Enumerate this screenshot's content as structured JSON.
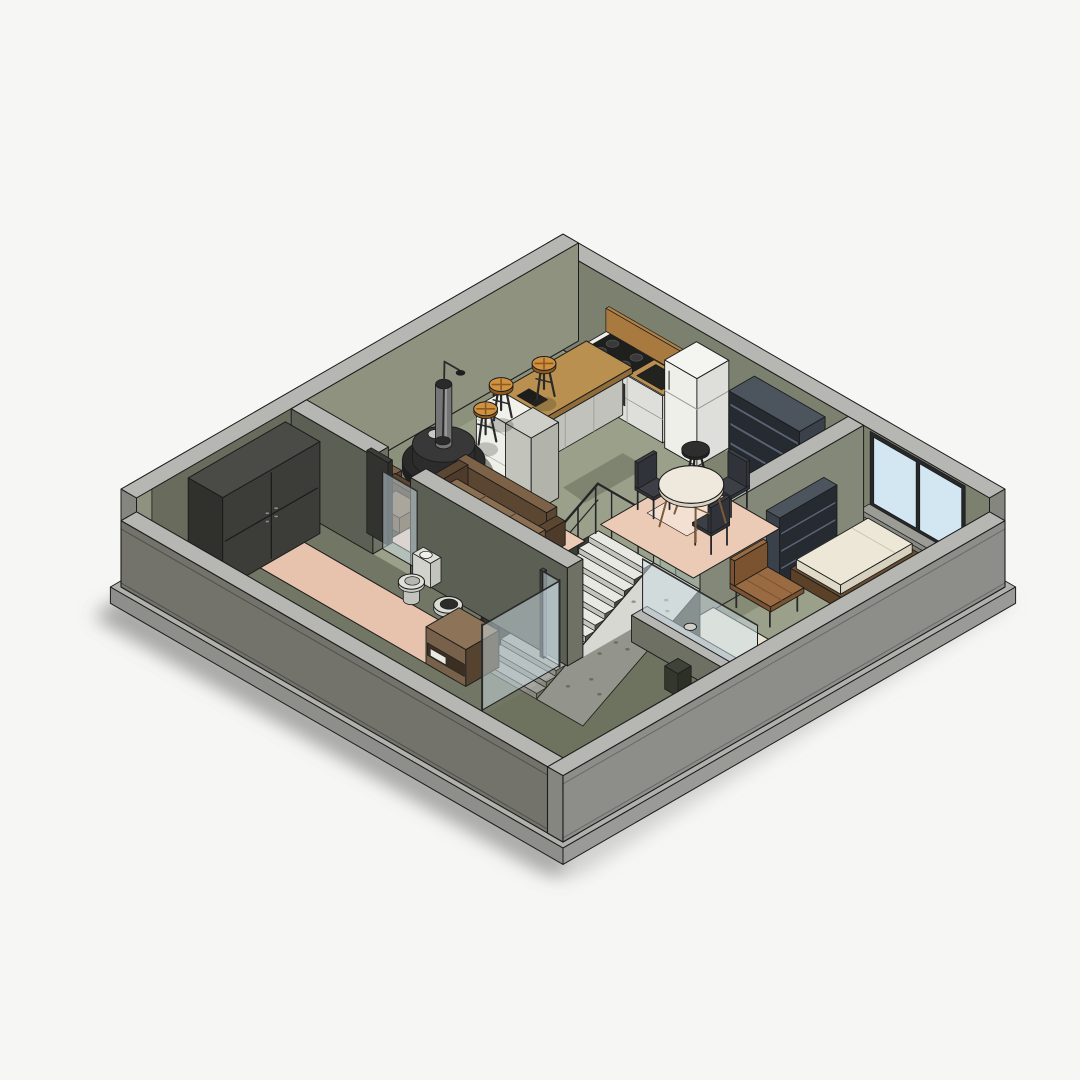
{
  "meta": {
    "title": "Isometric 3D apartment floor plan section render",
    "style": "revit-style cutaway axonometric view",
    "background": "#f6f6f5"
  },
  "rooms": [
    {
      "name": "kitchen"
    },
    {
      "name": "dining-area"
    },
    {
      "name": "living-room"
    },
    {
      "name": "bedroom"
    },
    {
      "name": "bathroom"
    },
    {
      "name": "stairwell"
    },
    {
      "name": "south-room"
    }
  ],
  "objects": [
    "base-slab",
    "drop-shadow",
    "exterior-walls",
    "window-band",
    "kitchen-counter",
    "range-cooktop",
    "kitchen-sink",
    "refrigerator",
    "shelving-unit",
    "kitchen-island",
    "dishwasher",
    "tall-cabinet",
    "bar-stool",
    "black-stool",
    "dining-table",
    "dining-chair",
    "staircase",
    "stair-railing",
    "glass-balustrade",
    "concrete-ramp",
    "bench",
    "bed",
    "area-rug",
    "fireplace",
    "floor-lamp",
    "sofa-large",
    "sofa-small",
    "ottoman",
    "coffee-table",
    "toilet",
    "pedestal-sink",
    "bathroom-vanity",
    "shower-glass",
    "bath-mat",
    "wardrobe",
    "glass-partition",
    "wall-sconce"
  ],
  "palette": {
    "bg": "#f6f6f5",
    "ink": "#1c1c1c",
    "shadow1": "rgba(130,130,127,0.55)",
    "shadow2": "rgba(163,163,160,0.45)",
    "slabTop": "#b0b0ac",
    "slabFace": "#8e8e8a",
    "slabSide": "#9a9a96",
    "wallTop": "#b6b6b2",
    "neFace": "#7c806e",
    "nwFace": "#8e927e",
    "wallDarkFace": "#696c5c",
    "extFaceSW": "#73736c",
    "extFaceSE": "#8d8d89",
    "endCap": "#868680",
    "floor": "#9aa089",
    "floorShadow": "rgba(44,48,36,0.40)",
    "patchShadow": "rgba(50,55,42,0.26)",
    "slotFloor": "#53564a",
    "pitFace": "#43463b",
    "pitFaceW": "#3a3d33",
    "tread": "#e9e9e4",
    "riser": "#c4c4be",
    "ramp": "#d8d8d2",
    "speckle": "#95958b",
    "railing": "#26262a",
    "glassBlue": "#d2e7f1",
    "glassPale": "rgba(203,222,229,0.5)",
    "glassGreen": "rgba(188,210,196,0.45)",
    "frame": "#26282a",
    "woodTop": "#b9904f",
    "woodSide": "#8f6c3a",
    "white": "#efefea",
    "whiteShade": "#dededa",
    "whiteSide": "#cfcfc9",
    "steel": "#2c2c2c",
    "shelfFront": "#262b31",
    "shelfSide": "#3a414a",
    "shelfTop": "#4c545e",
    "shelfSlat": "#566070",
    "orange": "#d09140",
    "orangeDark": "#8a5a20",
    "sofa": "#8a6f52",
    "sofaFront": "#75593d",
    "sofaFrame": "#5b4631",
    "rugLiving": "#eccbb6",
    "rugLight": "#f4e0d2",
    "bathMat": "#e7c3ae",
    "rugBeige": "#e8e3d0",
    "fireDark": "#2a2a2a",
    "fireMid": "#383838",
    "chimney": "#757575",
    "chimneyHi": "#9a9a9a",
    "tableWhite": "#efe9dd",
    "tableRim": "#d9d2c2",
    "chair": "#3c4046",
    "chairDark": "#30343a",
    "toilet": "#dfdfda",
    "toiletShade": "#c4c4bf",
    "vanity": "#8d7358",
    "vanityFront": "#77614a",
    "vanityDark": "#55432f",
    "wardrobe": "#3c3c38",
    "wardrobeSide": "#30302d",
    "wardrobeTop": "#4a4a46",
    "benchWood": "#9a6b42",
    "benchDark": "#7c5331",
    "bedFrame": "#6b4f35",
    "mattress": "#ece7d7",
    "mattressSide": "#d6d0be"
  }
}
